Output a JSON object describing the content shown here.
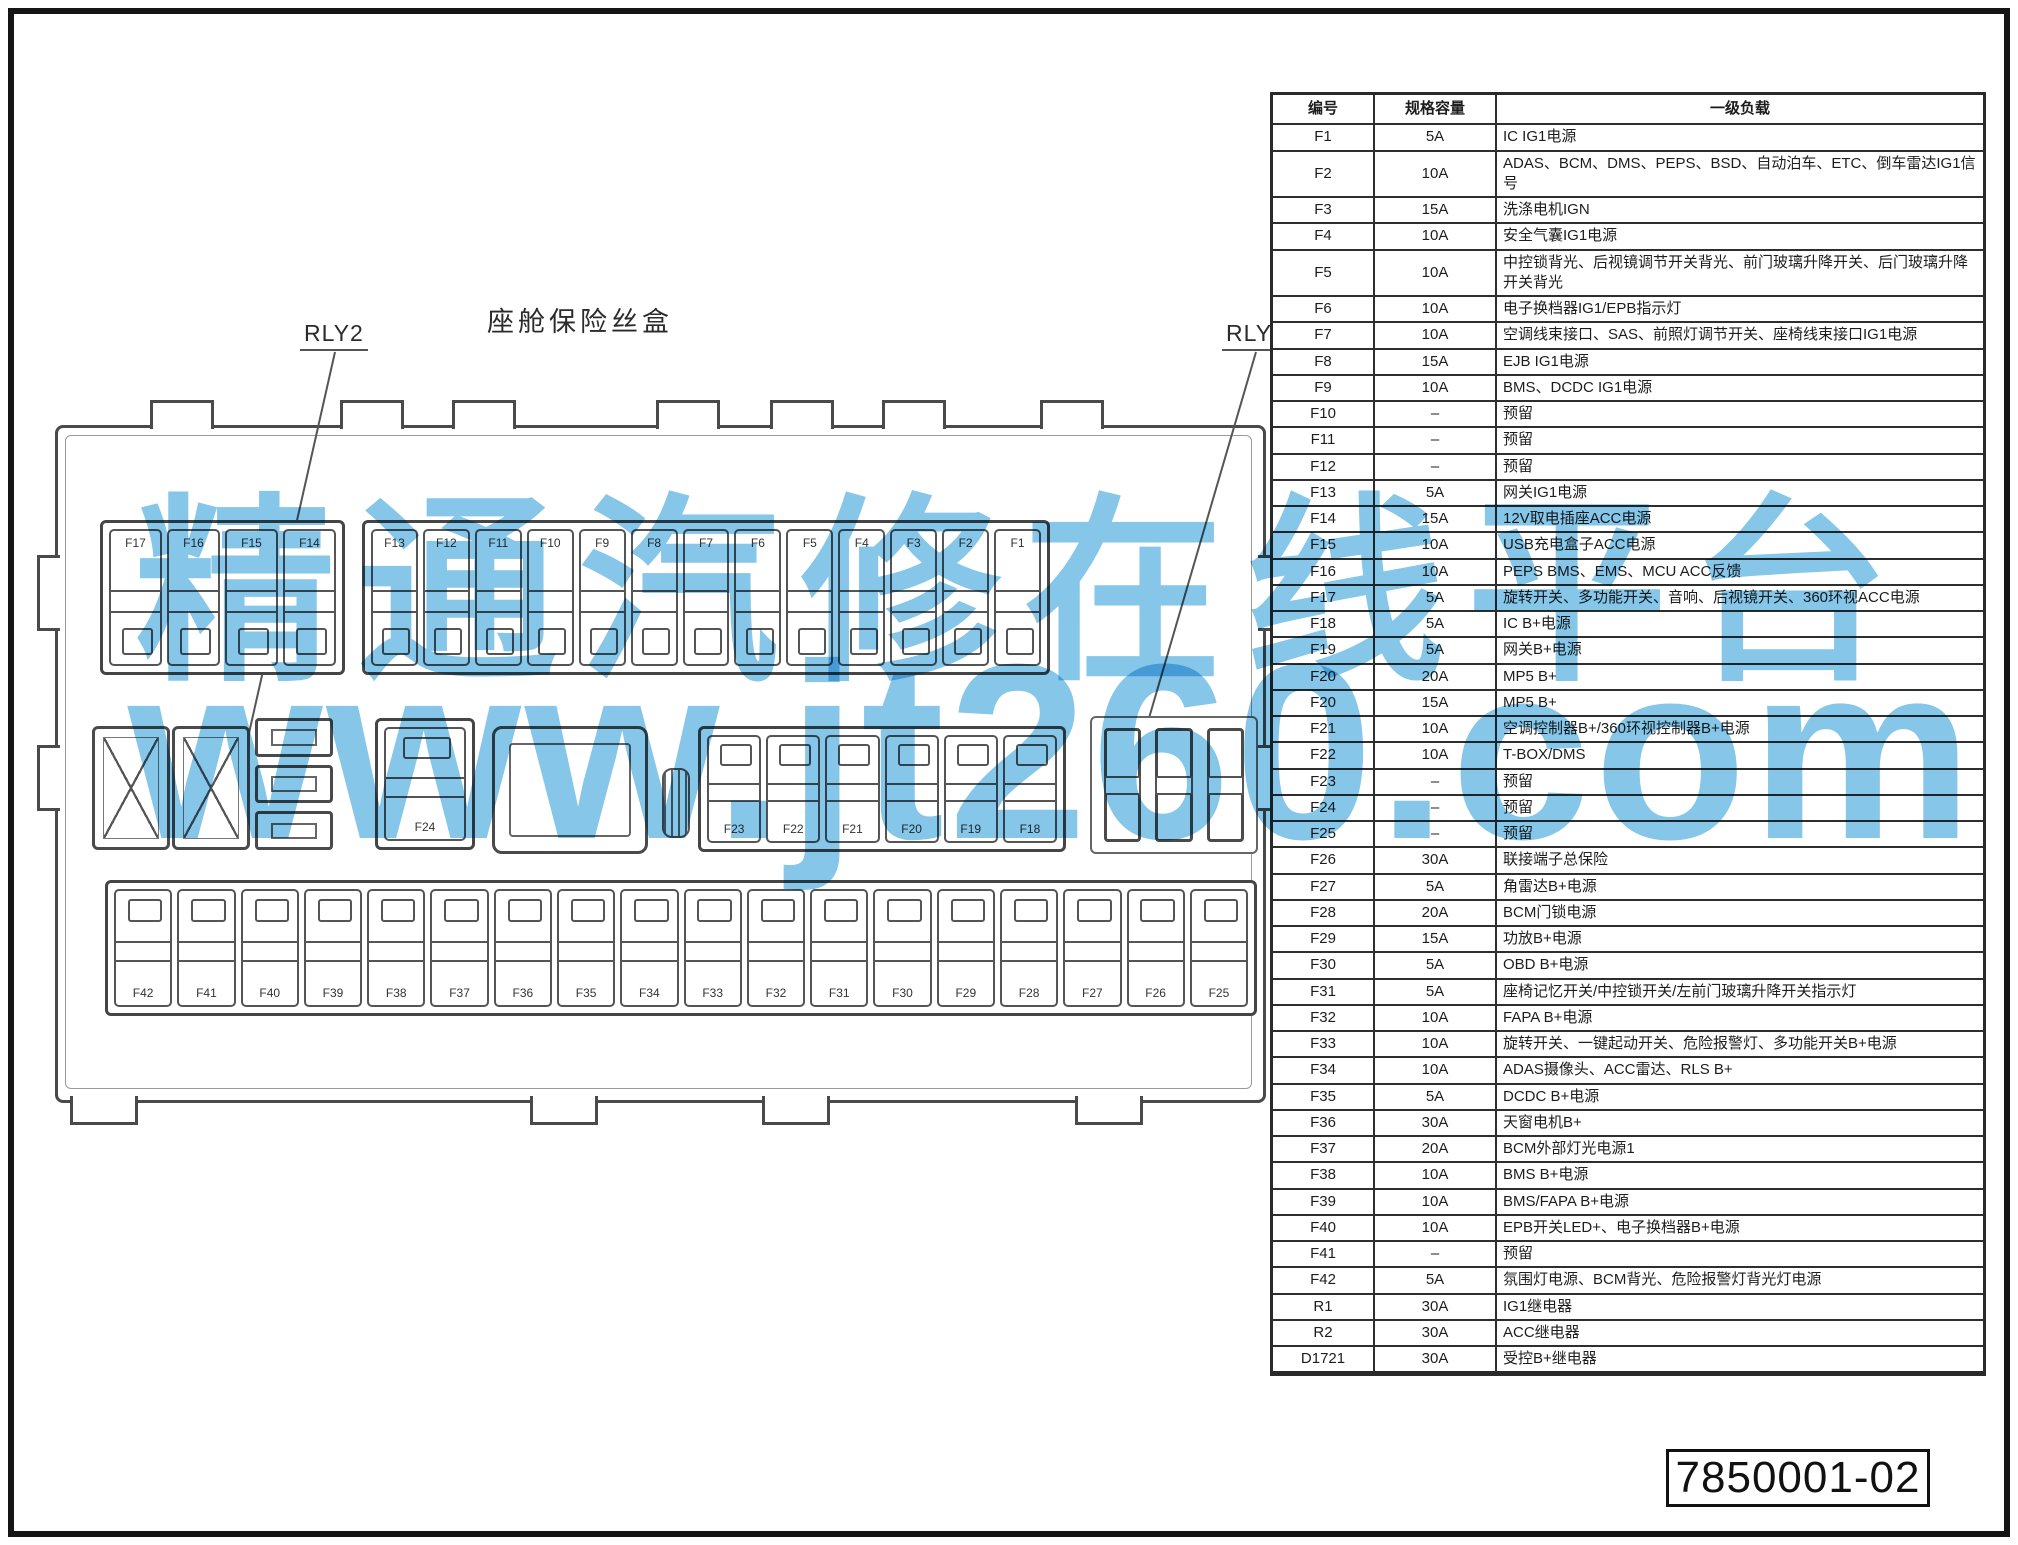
{
  "diagram": {
    "title": "座舱保险丝盒",
    "rly2_label": "RLY2",
    "rly1_label": "RLY1",
    "top_left_fuses": [
      "F17",
      "F16",
      "F15",
      "F14"
    ],
    "top_main_fuses": [
      "F13",
      "F12",
      "F11",
      "F10",
      "F9",
      "F8",
      "F7",
      "F6",
      "F5",
      "F4",
      "F3",
      "F2",
      "F1"
    ],
    "middle_single_fuse": [
      "F24"
    ],
    "middle_fuses": [
      "F23",
      "F22",
      "F21",
      "F20",
      "F19",
      "F18"
    ],
    "bottom_fuses": [
      "F42",
      "F41",
      "F40",
      "F39",
      "F38",
      "F37",
      "F36",
      "F35",
      "F34",
      "F33",
      "F32",
      "F31",
      "F30",
      "F29",
      "F28",
      "F27",
      "F26",
      "F25"
    ]
  },
  "table": {
    "headers": [
      "编号",
      "规格容量",
      "一级负载"
    ],
    "rows": [
      {
        "id": "F1",
        "rating": "5A",
        "load": "IC IG1电源"
      },
      {
        "id": "F2",
        "rating": "10A",
        "load": "ADAS、BCM、DMS、PEPS、BSD、自动泊车、ETC、倒车雷达IG1信号"
      },
      {
        "id": "F3",
        "rating": "15A",
        "load": "洗涤电机IGN"
      },
      {
        "id": "F4",
        "rating": "10A",
        "load": "安全气囊IG1电源"
      },
      {
        "id": "F5",
        "rating": "10A",
        "load": "中控锁背光、后视镜调节开关背光、前门玻璃升降开关、后门玻璃升降开关背光"
      },
      {
        "id": "F6",
        "rating": "10A",
        "load": "电子换档器IG1/EPB指示灯"
      },
      {
        "id": "F7",
        "rating": "10A",
        "load": "空调线束接口、SAS、前照灯调节开关、座椅线束接口IG1电源"
      },
      {
        "id": "F8",
        "rating": "15A",
        "load": "EJB IG1电源"
      },
      {
        "id": "F9",
        "rating": "10A",
        "load": "BMS、DCDC IG1电源"
      },
      {
        "id": "F10",
        "rating": "–",
        "load": "预留"
      },
      {
        "id": "F11",
        "rating": "–",
        "load": "预留"
      },
      {
        "id": "F12",
        "rating": "–",
        "load": "预留"
      },
      {
        "id": "F13",
        "rating": "5A",
        "load": "网关IG1电源"
      },
      {
        "id": "F14",
        "rating": "15A",
        "load": "12V取电插座ACC电源"
      },
      {
        "id": "F15",
        "rating": "10A",
        "load": "USB充电盒子ACC电源"
      },
      {
        "id": "F16",
        "rating": "10A",
        "load": "PEPS BMS、EMS、MCU ACC反馈"
      },
      {
        "id": "F17",
        "rating": "5A",
        "load": "旋转开关、多功能开关、音响、后视镜开关、360环视ACC电源"
      },
      {
        "id": "F18",
        "rating": "5A",
        "load": "IC B+电源"
      },
      {
        "id": "F19",
        "rating": "5A",
        "load": "网关B+电源"
      },
      {
        "id": "F20",
        "rating": "20A",
        "load": "MP5 B+"
      },
      {
        "id": "F20",
        "rating": "15A",
        "load": "MP5 B+"
      },
      {
        "id": "F21",
        "rating": "10A",
        "load": "空调控制器B+/360环视控制器B+电源"
      },
      {
        "id": "F22",
        "rating": "10A",
        "load": "T-BOX/DMS"
      },
      {
        "id": "F23",
        "rating": "–",
        "load": "预留"
      },
      {
        "id": "F24",
        "rating": "–",
        "load": "预留"
      },
      {
        "id": "F25",
        "rating": "–",
        "load": "预留"
      },
      {
        "id": "F26",
        "rating": "30A",
        "load": "联接端子总保险"
      },
      {
        "id": "F27",
        "rating": "5A",
        "load": "角雷达B+电源"
      },
      {
        "id": "F28",
        "rating": "20A",
        "load": "BCM门锁电源"
      },
      {
        "id": "F29",
        "rating": "15A",
        "load": "功放B+电源"
      },
      {
        "id": "F30",
        "rating": "5A",
        "load": "OBD B+电源"
      },
      {
        "id": "F31",
        "rating": "5A",
        "load": "座椅记忆开关/中控锁开关/左前门玻璃升降开关指示灯"
      },
      {
        "id": "F32",
        "rating": "10A",
        "load": "FAPA B+电源"
      },
      {
        "id": "F33",
        "rating": "10A",
        "load": "旋转开关、一键起动开关、危险报警灯、多功能开关B+电源"
      },
      {
        "id": "F34",
        "rating": "10A",
        "load": "ADAS摄像头、ACC雷达、RLS B+"
      },
      {
        "id": "F35",
        "rating": "5A",
        "load": "DCDC B+电源"
      },
      {
        "id": "F36",
        "rating": "30A",
        "load": "天窗电机B+"
      },
      {
        "id": "F37",
        "rating": "20A",
        "load": "BCM外部灯光电源1"
      },
      {
        "id": "F38",
        "rating": "10A",
        "load": "BMS B+电源"
      },
      {
        "id": "F39",
        "rating": "10A",
        "load": "BMS/FAPA B+电源"
      },
      {
        "id": "F40",
        "rating": "10A",
        "load": "EPB开关LED+、电子换档器B+电源"
      },
      {
        "id": "F41",
        "rating": "–",
        "load": "预留"
      },
      {
        "id": "F42",
        "rating": "5A",
        "load": "氛围灯电源、BCM背光、危险报警灯背光灯电源"
      },
      {
        "id": "R1",
        "rating": "30A",
        "load": "IG1继电器"
      },
      {
        "id": "R2",
        "rating": "30A",
        "load": "ACC继电器"
      },
      {
        "id": "D1721",
        "rating": "30A",
        "load": "受控B+继电器"
      }
    ]
  },
  "watermark": {
    "line1": "精通汽修在线平台",
    "line2": "www.jt260.com",
    "color": "#6fbce6"
  },
  "doc_number": "7850001-02"
}
